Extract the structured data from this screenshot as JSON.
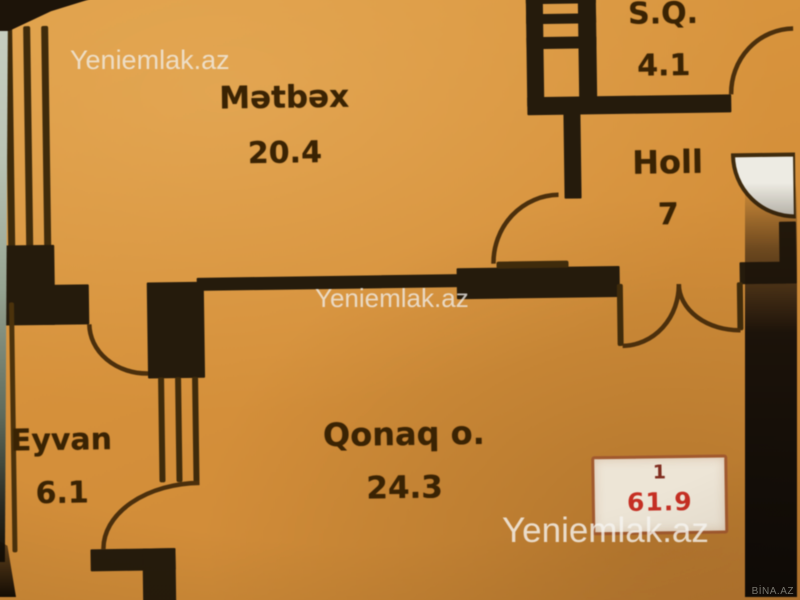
{
  "plan": {
    "rooms": [
      {
        "key": "matbax",
        "name": "Mətbəx",
        "area": "20.4"
      },
      {
        "key": "sq",
        "name": "S.Q.",
        "area": "4.1"
      },
      {
        "key": "holl",
        "name": "Holl",
        "area": "7"
      },
      {
        "key": "eyvan",
        "name": "Eyvan",
        "area": "6.1"
      },
      {
        "key": "qonaq",
        "name": "Qonaq o.",
        "area": "24.3"
      }
    ],
    "badge": {
      "unit": "1",
      "total_area": "61.9"
    }
  },
  "watermarks": {
    "site": "Yeniemlak.az",
    "source": "BİNA.AZ"
  },
  "colors": {
    "floor": "#d29140",
    "wall": "#251c0e",
    "arc_line": "#4a300f",
    "badge_bg": "#ece4d6",
    "badge_total": "#bf3126",
    "watermark": "#f0f0ee"
  }
}
